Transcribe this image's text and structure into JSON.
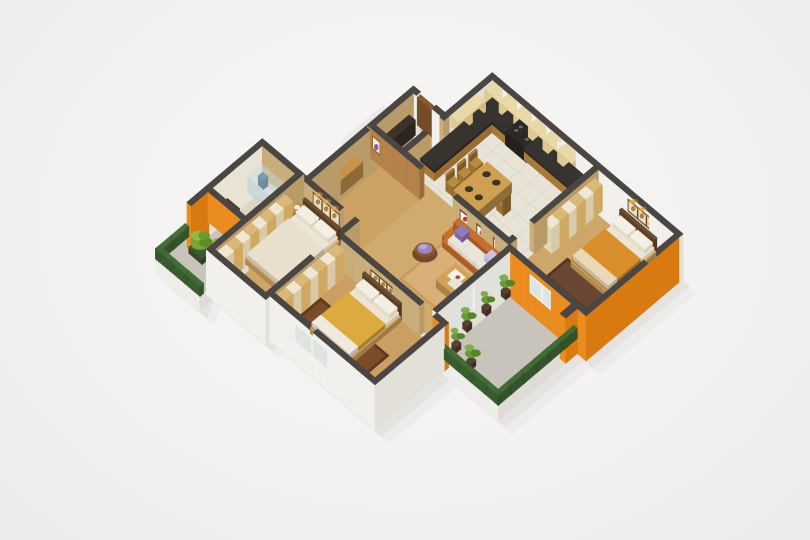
{
  "meta": {
    "title": "3D isometric apartment floor plan render",
    "alt": "Rendered 3D cutaway floor plan of a two-three bedroom apartment with kitchen, living room, bathroom and two balconies"
  },
  "canvas": {
    "w": 810,
    "h": 540,
    "bg": "#f5f4f2"
  },
  "projection": {
    "sx": 17.5,
    "sy": 14.8,
    "wall_h_px": 30,
    "ox": 410,
    "oy": 33
  },
  "palette": {
    "wall_top": "#4a4643",
    "wall_white_s": "#f2f0ec",
    "wall_white_e": "#e3e0da",
    "wall_tan_s": "#c9ad7b",
    "wall_tan_e": "#b99b68",
    "orange_s": "#ea8c20",
    "orange_e": "#d97a10",
    "wood_partition_s": "#b5824a",
    "wood_partition_e": "#9c6c38",
    "bath_inner": "#e9e3d3",
    "rail_top": "#3e6a33",
    "rail_s": "#35592b",
    "rail_e": "#2f5026",
    "shadow1": "#dedddb",
    "shadow2": "#e6e5e3"
  },
  "scene": {
    "shadow_hull": [
      [
        4.7,
        0
      ],
      [
        15.6,
        0
      ],
      [
        15.6,
        5.54
      ],
      [
        15.1,
        5.54
      ],
      [
        15.1,
        10.06
      ],
      [
        11.9,
        10.06
      ],
      [
        11.9,
        13.9
      ],
      [
        5.9,
        13.9
      ],
      [
        5.9,
        14.14
      ],
      [
        2.5,
        14.14
      ],
      [
        2.9,
        14.9
      ],
      [
        0.36,
        14.9
      ],
      [
        0.36,
        7.6
      ],
      [
        2.9,
        7.6
      ],
      [
        2.9,
        2.7
      ],
      [
        4.7,
        2.7
      ]
    ],
    "floors": [
      {
        "n": "kitchen-floor",
        "r": [
          4.94,
          0.24,
          10.76,
          4.7
        ],
        "c": "#e7e3d6",
        "grid": true
      },
      {
        "n": "dining-living-floor",
        "r": [
          4.94,
          4.7,
          11.0,
          9.7
        ],
        "c": "#d1aa6d"
      },
      {
        "n": "entry-room-floor",
        "r": [
          3.14,
          2.94,
          4.7,
          5.1
        ],
        "c": "#c59a5d"
      },
      {
        "n": "entry-hall-floor",
        "r": [
          2.9,
          5.34,
          5.9,
          8.8
        ],
        "c": "#cba263"
      },
      {
        "n": "master-bedroom-floor",
        "r": [
          2.74,
          9.04,
          5.66,
          13.9
        ],
        "c": "#cda668"
      },
      {
        "n": "bedroom2-floor",
        "r": [
          5.9,
          9.94,
          11.66,
          13.66
        ],
        "c": "#c9a061"
      },
      {
        "n": "bedroom3-floor",
        "r": [
          11.0,
          0.24,
          15.36,
          5.3
        ],
        "c": "#cda668"
      },
      {
        "n": "bathroom-floor",
        "r": [
          0.6,
          9.04,
          2.5,
          11.9
        ],
        "c": "#ddd5c3"
      }
    ],
    "slabs": [
      {
        "n": "balcony-left-floor",
        "r": [
          0.36,
          12.14,
          2.9,
          14.9
        ],
        "c": "#c8c4bb"
      },
      {
        "n": "balcony-right-floor",
        "r": [
          11.24,
          5.54,
          15.1,
          10.06
        ],
        "c": "#c8c4bb"
      },
      {
        "n": "entry-landing",
        "r": [
          1.7,
          3.2,
          2.9,
          5.6
        ],
        "c": "#eceae6"
      }
    ],
    "rugs": [
      {
        "n": "living-room-rug",
        "r": [
          8.0,
          6.2,
          11.0,
          8.6
        ],
        "c": "#d8b077",
        "b": "#c89c5e"
      },
      {
        "n": "bedroom2-rug",
        "r": [
          6.4,
          11.5,
          10.3,
          13.45
        ],
        "c": "#7b4b2a",
        "b": "#5e3a1e"
      },
      {
        "n": "bedroom3-rug",
        "r": [
          12.1,
          3.1,
          15.0,
          4.35
        ],
        "c": "#6a4732",
        "b": "#523525"
      },
      {
        "n": "shower-tray",
        "r": [
          0.72,
          9.15,
          2.38,
          10.05
        ],
        "c": "#e9e6da",
        "b": "#dcd8c8"
      }
    ],
    "walls": [
      {
        "n": "kitchen-north-wall",
        "r": [
          4.7,
          0,
          15.6,
          0.24
        ],
        "k": "ext",
        "z0": -0.5
      },
      {
        "n": "east-wall-orange",
        "r": [
          15.36,
          0.24,
          15.6,
          5.54
        ],
        "k": "orange",
        "z0": -0.5
      },
      {
        "n": "bedroom3-south-wall",
        "r": [
          11.0,
          5.3,
          15.36,
          5.54
        ],
        "k": "orange",
        "z0": -0.5
      },
      {
        "n": "living-east-wall",
        "r": [
          11.0,
          5.54,
          11.24,
          9.7
        ],
        "k": "ext",
        "z0": -0.5
      },
      {
        "n": "balcony-step-wall",
        "r": [
          11.24,
          9.7,
          11.9,
          9.94
        ],
        "k": "orange",
        "z0": -0.5
      },
      {
        "n": "bedroom2-east-wall",
        "r": [
          11.66,
          9.94,
          11.9,
          13.9
        ],
        "k": "ext",
        "z0": -0.5
      },
      {
        "n": "bedroom2-south-wall",
        "r": [
          5.9,
          13.66,
          11.66,
          13.9
        ],
        "k": "ext",
        "z0": -0.5
      },
      {
        "n": "master-south-wall",
        "r": [
          2.5,
          13.9,
          5.9,
          14.14
        ],
        "k": "ext",
        "z0": -0.5
      },
      {
        "n": "master-west-wall",
        "r": [
          2.5,
          8.8,
          2.74,
          13.9
        ],
        "k": "tan"
      },
      {
        "n": "master-north-wall-a",
        "r": [
          0.6,
          8.8,
          5.0,
          9.04
        ],
        "k": "tan"
      },
      {
        "n": "master-north-wall-b",
        "r": [
          5.7,
          8.8,
          5.9,
          9.04
        ],
        "k": "tan"
      },
      {
        "n": "master-east-wall",
        "r": [
          5.66,
          8.8,
          5.9,
          13.9
        ],
        "k": "tan"
      },
      {
        "n": "bathroom-west-wall",
        "r": [
          0.36,
          8.8,
          0.6,
          12.1
        ],
        "k": "bathw",
        "z0": -0.5
      },
      {
        "n": "bathroom-balcony-wall",
        "r": [
          0.36,
          12.1,
          0.6,
          13.1
        ],
        "k": "orange",
        "z0": -0.5
      },
      {
        "n": "bathroom-south-wall",
        "r": [
          0.6,
          11.9,
          2.5,
          12.14
        ],
        "k": "orange"
      },
      {
        "n": "foyer-west-wall",
        "r": [
          2.9,
          2.94,
          3.14,
          8.8
        ],
        "k": "tan",
        "z0": -0.5
      },
      {
        "n": "entry-north-wall-a",
        "r": [
          2.9,
          2.7,
          3.3,
          2.94
        ],
        "k": "ext",
        "z0": -0.5
      },
      {
        "n": "entry-north-wall-b",
        "r": [
          4.2,
          2.7,
          4.7,
          2.94
        ],
        "k": "ext",
        "z0": -0.5
      },
      {
        "n": "kitchen-west-wall",
        "r": [
          4.7,
          0.24,
          4.94,
          2.7
        ],
        "k": "ext",
        "z0": -0.5
      },
      {
        "n": "kitchen-foyer-wall-a",
        "r": [
          4.7,
          2.7,
          4.94,
          3.0
        ],
        "k": "tan"
      },
      {
        "n": "kitchen-foyer-wall-b",
        "r": [
          4.7,
          3.9,
          4.94,
          5.1
        ],
        "k": "tan"
      },
      {
        "n": "niche-partition",
        "r": [
          2.9,
          5.1,
          5.9,
          5.34
        ],
        "k": "wood"
      },
      {
        "n": "sofa-partition",
        "r": [
          7.8,
          5.1,
          11.0,
          5.34
        ],
        "k": "tan"
      },
      {
        "n": "bedroom3-west-wall-a",
        "r": [
          10.76,
          0.24,
          11.0,
          3.9
        ],
        "k": "tan"
      },
      {
        "n": "bedroom3-west-wall-b",
        "r": [
          10.76,
          4.9,
          11.0,
          5.3
        ],
        "k": "tan"
      },
      {
        "n": "bedroom2-north-wall-a",
        "r": [
          5.9,
          9.7,
          10.5,
          9.94
        ],
        "k": "tan"
      },
      {
        "n": "bedroom2-north-wall-b",
        "r": [
          11.3,
          9.7,
          11.66,
          9.94
        ],
        "k": "tan"
      },
      {
        "n": "balcony-pillar",
        "r": [
          14.78,
          5.54,
          15.1,
          6.2
        ],
        "k": "orange",
        "z0": -0.5
      }
    ],
    "rails": [
      {
        "n": "balcony-left-rail-west",
        "r": [
          0.36,
          13.2,
          0.56,
          14.9
        ]
      },
      {
        "n": "balcony-left-rail-south",
        "r": [
          0.36,
          14.7,
          2.9,
          14.9
        ]
      },
      {
        "n": "balcony-right-rail-east",
        "r": [
          14.9,
          5.54,
          15.1,
          10.06
        ]
      },
      {
        "n": "balcony-right-rail-south",
        "r": [
          11.24,
          9.86,
          15.1,
          10.06
        ]
      }
    ],
    "furniture": [
      {
        "n": "master-bed",
        "t": "bed",
        "r": [
          3.1,
          9.14,
          5.2,
          12.5
        ],
        "blanket": "#e8e0cd",
        "foot": null
      },
      {
        "n": "master-nightstand-left",
        "t": "cab",
        "r": [
          2.78,
          9.15,
          3.06,
          9.6
        ],
        "h": 0.24,
        "c": "#c09050",
        "dot": "#f4efe2"
      },
      {
        "n": "master-nightstand-right",
        "t": "cab",
        "r": [
          5.26,
          9.15,
          5.54,
          9.6
        ],
        "h": 0.24,
        "c": "#c09050",
        "dot": "#f4efe2"
      },
      {
        "n": "master-wardrobe",
        "t": "wardrobe",
        "r": [
          2.74,
          9.9,
          3.18,
          13.7
        ]
      },
      {
        "n": "bedroom2-bed",
        "t": "bed",
        "r": [
          7.3,
          9.94,
          9.5,
          13.0
        ],
        "blanket": "#dcaa3f",
        "foot": "#efeadd"
      },
      {
        "n": "bedroom2-wardrobe",
        "t": "wardrobe",
        "r": [
          5.9,
          10.1,
          6.34,
          13.5
        ]
      },
      {
        "n": "bedroom3-bed",
        "t": "bed",
        "r": [
          12.5,
          0.45,
          14.6,
          3.3
        ],
        "blanket": "#d98f2b",
        "foot": "#e9d9b8"
      },
      {
        "n": "bedroom3-wardrobe",
        "t": "wardrobe",
        "r": [
          11.05,
          0.5,
          11.49,
          3.4
        ]
      },
      {
        "n": "hall-console",
        "t": "cab",
        "r": [
          3.14,
          6.2,
          3.5,
          7.6
        ],
        "h": 0.5,
        "c": "#c7934b"
      },
      {
        "n": "entry-cabinet",
        "t": "cab",
        "r": [
          3.25,
          3.3,
          3.6,
          4.9
        ],
        "h": 0.5,
        "c": "#3a332c"
      },
      {
        "n": "entry-door",
        "t": "cab",
        "r": [
          3.32,
          2.72,
          4.18,
          2.9
        ],
        "h": 0.92,
        "c": "#8a5a2e"
      },
      {
        "n": "sofa",
        "t": "sofa",
        "r": [
          8.15,
          5.38,
          10.9,
          6.3
        ],
        "c": "#c96f2d"
      },
      {
        "n": "coffee-table",
        "t": "table",
        "r": [
          9.35,
          6.75,
          10.6,
          7.85
        ],
        "h": 0.26,
        "c": "#d2a258",
        "mag": true
      },
      {
        "n": "round-chair",
        "t": "papasan",
        "x": 7.95,
        "y": 7.1,
        "rr": 0.72
      },
      {
        "n": "dining-table",
        "t": "table",
        "r": [
          6.9,
          2.5,
          8.3,
          4.4
        ],
        "h": 0.34,
        "c": "#cfa052",
        "plates": 4
      },
      {
        "n": "dining-chair-1",
        "t": "chair",
        "r": [
          6.35,
          2.6,
          6.75,
          3.0
        ],
        "face": "e"
      },
      {
        "n": "dining-chair-2",
        "t": "chair",
        "r": [
          6.35,
          3.25,
          6.75,
          3.65
        ],
        "face": "e"
      },
      {
        "n": "dining-chair-3",
        "t": "chair",
        "r": [
          6.35,
          3.9,
          6.75,
          4.3
        ],
        "face": "e"
      },
      {
        "n": "dining-chair-4",
        "t": "chair",
        "r": [
          8.45,
          3.1,
          8.85,
          3.5
        ],
        "face": "w"
      },
      {
        "n": "kitchen-counter-north",
        "t": "counter",
        "r": [
          4.94,
          0.24,
          10.16,
          1.02
        ],
        "app": [
          6.5,
          7.7
        ]
      },
      {
        "n": "kitchen-counter-west",
        "t": "counter",
        "r": [
          4.94,
          1.02,
          5.7,
          4.3
        ]
      },
      {
        "n": "kitchen-upper-cabinet-north",
        "t": "upper",
        "r": [
          5.0,
          0.24,
          10.0,
          0.74
        ]
      },
      {
        "n": "kitchen-upper-cabinet-west",
        "t": "upper",
        "r": [
          4.94,
          1.1,
          5.42,
          2.6
        ]
      },
      {
        "n": "shower-enclosure",
        "t": "glassbox",
        "r": [
          0.74,
          9.17,
          2.36,
          10.03
        ],
        "h": 0.52
      },
      {
        "n": "shower-fixture",
        "t": "cab",
        "r": [
          0.8,
          9.22,
          1.1,
          9.47
        ],
        "h": 0.3,
        "c": "#3a647e"
      },
      {
        "n": "bathroom-vanity",
        "t": "cab",
        "r": [
          0.72,
          11.15,
          1.4,
          11.85
        ],
        "h": 0.34,
        "c": "#4a382a",
        "dot": "#f0efe9"
      },
      {
        "n": "toilet",
        "t": "toilet",
        "r": [
          1.85,
          10.4,
          2.35,
          10.95
        ]
      }
    ],
    "plants": [
      {
        "n": "balcony-plant-1",
        "t": "plant",
        "x": 11.62,
        "y": 6.15,
        "rr": 0.34
      },
      {
        "n": "balcony-plant-2",
        "t": "plant",
        "x": 11.62,
        "y": 7.25,
        "rr": 0.3
      },
      {
        "n": "balcony-plant-3",
        "t": "plant",
        "x": 11.62,
        "y": 8.35,
        "rr": 0.34
      },
      {
        "n": "balcony-plant-4",
        "t": "plant",
        "x": 12.0,
        "y": 9.35,
        "rr": 0.3
      },
      {
        "n": "balcony-plant-5",
        "t": "plant",
        "x": 13.0,
        "y": 9.5,
        "rr": 0.36
      },
      {
        "n": "left-balcony-shrub-1",
        "t": "shrub",
        "x": 1.5,
        "y": 13.5,
        "rr": 0.55
      },
      {
        "n": "left-balcony-shrub-2",
        "t": "shrub",
        "x": 2.3,
        "y": 13.15,
        "rr": 0.48
      }
    ],
    "decals": [
      {
        "n": "master-bed-art",
        "t": "art",
        "y": 9.04,
        "x1": 3.5,
        "x2": 5.0,
        "z1": 0.45,
        "z2": 0.88,
        "lights": true
      },
      {
        "n": "bedroom2-bed-art",
        "t": "art",
        "y": 9.94,
        "x1": 7.7,
        "x2": 9.1,
        "z1": 0.45,
        "z2": 0.82,
        "lights": false
      },
      {
        "n": "bedroom3-bed-art",
        "t": "art",
        "y": 0.24,
        "x1": 12.7,
        "x2": 14.3,
        "z1": 0.45,
        "z2": 0.85,
        "lights": true
      },
      {
        "n": "kitchen-window",
        "t": "window",
        "y": 0.24,
        "x1": 8.7,
        "x2": 9.9,
        "z1": 0.18,
        "z2": 0.8
      },
      {
        "n": "bedroom3-window",
        "t": "window",
        "y": 5.54,
        "x1": 12.4,
        "x2": 13.8,
        "z1": 0.2,
        "z2": 0.8
      },
      {
        "n": "bedroom2-window",
        "t": "window",
        "y": 13.9,
        "x1": 7.3,
        "x2": 9.3,
        "z1": 0.15,
        "z2": 0.82
      },
      {
        "n": "balcony-glass-door",
        "t": "glass",
        "x": 11.24,
        "y1": 5.9,
        "y2": 9.3,
        "z1": 0.06,
        "z2": 0.85
      },
      {
        "n": "display-niche-1",
        "t": "niche",
        "y": 5.34,
        "x1": 3.2,
        "x2": 3.62,
        "z1": 0.35,
        "z2": 0.78
      },
      {
        "n": "display-niche-2",
        "t": "niche",
        "y": 5.34,
        "x1": 3.85,
        "x2": 4.27,
        "z1": 0.35,
        "z2": 0.78
      },
      {
        "n": "display-niche-3",
        "t": "niche",
        "y": 5.34,
        "x1": 4.5,
        "x2": 4.92,
        "z1": 0.35,
        "z2": 0.78
      },
      {
        "n": "display-niche-4",
        "t": "niche",
        "y": 5.34,
        "x1": 5.15,
        "x2": 5.57,
        "z1": 0.35,
        "z2": 0.78
      },
      {
        "n": "living-wall-frame-1",
        "t": "frame",
        "y": 5.34,
        "x1": 8.2,
        "x2": 8.8,
        "z1": 0.45,
        "z2": 0.8
      },
      {
        "n": "living-wall-frame-2",
        "t": "frame",
        "y": 5.34,
        "x1": 9.15,
        "x2": 9.75,
        "z1": 0.45,
        "z2": 0.8
      },
      {
        "n": "living-wall-frame-3",
        "t": "frame",
        "y": 5.34,
        "x1": 10.1,
        "x2": 10.7,
        "z1": 0.45,
        "z2": 0.8
      }
    ]
  }
}
